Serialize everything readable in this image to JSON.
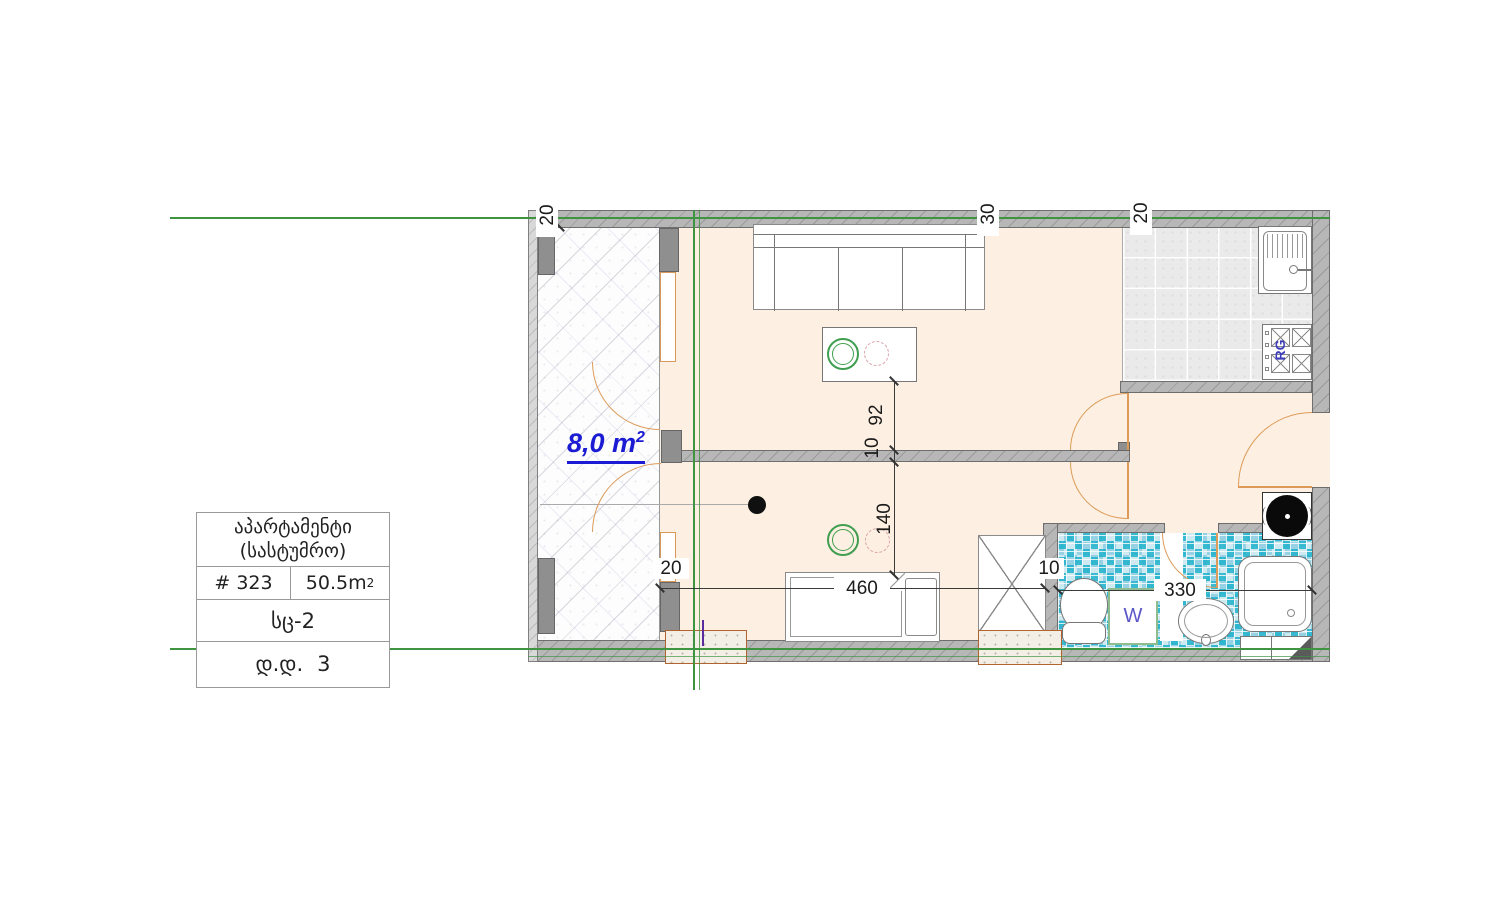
{
  "title_block": {
    "line1": "აპარტამენტი",
    "line2": "(სასტუმრო)",
    "unit_number": "# 323",
    "area_value": "50.5m",
    "area_sup": "2",
    "block_code": "სც-2",
    "row_label": "დ.დ.",
    "row_value": "3"
  },
  "plan": {
    "balcony_area": "8,0 m",
    "balcony_area_sup": "2",
    "washer_label": "W",
    "stove_label": "RG",
    "dims": {
      "top_left": "20",
      "top_middle": "30",
      "top_right": "20",
      "sofa_to_wall": "92",
      "partition_thickness": "10",
      "wall_to_bed": "140",
      "balcony_wall": "20",
      "bed_width": "460",
      "bathroom_wall": "10",
      "bathroom_width": "330"
    }
  },
  "colors": {
    "floor": "#fdf0e2",
    "wall": "#b7b7b7",
    "axis_green": "#3f9440",
    "door_orange": "#dd9b59",
    "area_text_blue": "#1b1bd4",
    "mosaic_teal": "#20b2cb"
  }
}
